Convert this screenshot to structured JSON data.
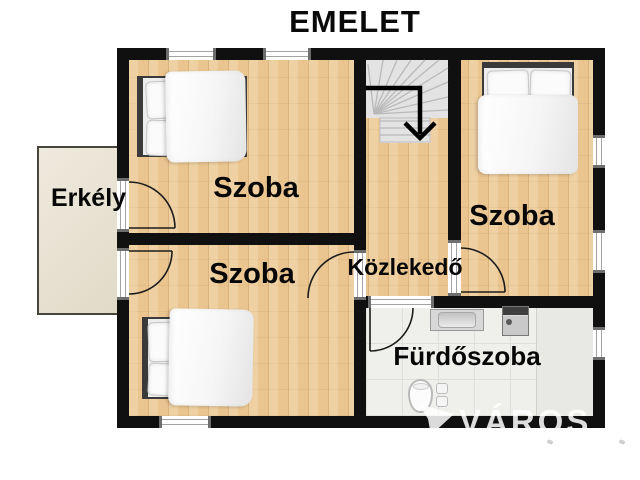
{
  "title": "EMELET",
  "floor_plan": {
    "rooms": [
      {
        "id": "bedroom-top",
        "label": "Szoba"
      },
      {
        "id": "bedroom-right",
        "label": "Szoba"
      },
      {
        "id": "bedroom-bottom",
        "label": "Szoba"
      },
      {
        "id": "hallway",
        "label": "Közlekedő"
      },
      {
        "id": "bathroom",
        "label": "Fürdőszoba"
      },
      {
        "id": "balcony",
        "label": "Erkély"
      }
    ],
    "stairs": {
      "direction": "down-arrow"
    }
  },
  "watermark": {
    "text": "VÁROS"
  },
  "colors": {
    "wall": "#101010",
    "wood_floor": "#eac58f",
    "tile_floor": "#efefec",
    "stairs": "#e3e3e3",
    "balcony": "#e9e3d2",
    "label_text": "#070707",
    "watermark_text": "rgba(255,255,255,0.86)"
  }
}
